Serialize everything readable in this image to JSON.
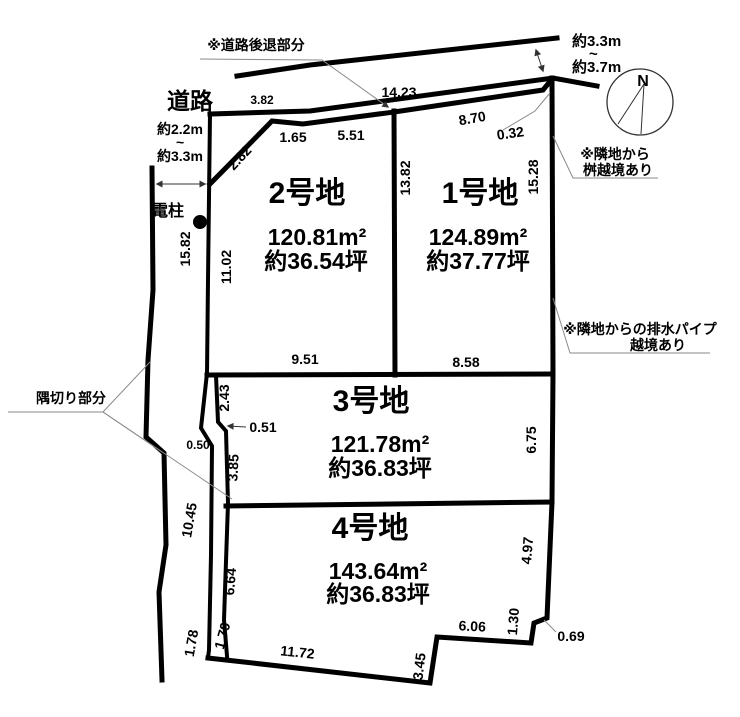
{
  "diagram": {
    "compass_label": "N",
    "road_label": "道路",
    "pole_label": "電柱",
    "setback_label": "※道路後退部分",
    "corner_cut_label": "隅切り部分",
    "masu_note": {
      "line1": "※隣地から",
      "line2": "桝越境あり"
    },
    "drain_note": {
      "line1": "※隣地からの排水パイプ",
      "line2": "越境あり"
    },
    "road_width_north": {
      "min": "約3.3m",
      "tilde": "~",
      "max": "約3.7m"
    },
    "road_width_west": {
      "min": "約2.2m",
      "tilde": "~",
      "max": "約3.3m"
    }
  },
  "plots": [
    {
      "name": "1号地",
      "area_m2": "124.89m²",
      "area_tsubo": "約37.77坪"
    },
    {
      "name": "2号地",
      "area_m2": "120.81m²",
      "area_tsubo": "約36.54坪"
    },
    {
      "name": "3号地",
      "area_m2": "121.78m²",
      "area_tsubo": "約36.83坪"
    },
    {
      "name": "4号地",
      "area_m2": "143.64m²",
      "area_tsubo": "約36.83坪"
    }
  ],
  "dimensions": {
    "front_west": "3.82",
    "front_main": "14.23",
    "plot2_corner": "2.82",
    "plot2_top_a": "1.65",
    "plot2_top_b": "5.51",
    "plot1_top": "8.70",
    "plot1_top_jog": "0.32",
    "plot1_west": "13.82",
    "plot1_east": "15.28",
    "plot1_south": "8.58",
    "plot2_west": "11.02",
    "plot2_south": "9.51",
    "west_line_upper": "15.82",
    "plot3_west_a": "2.43",
    "plot3_west_jog": "0.51",
    "road_jog": "0.50",
    "plot3_west_b": "3.85",
    "plot3_east": "6.75",
    "west_line_lower": "10.45",
    "plot4_west_a": "6.64",
    "plot4_west_b": "1.79",
    "west_line_end": "1.78",
    "plot4_south": "11.72",
    "plot4_south_b": "3.45",
    "plot4_south_c": "6.06",
    "plot4_east_jog_b": "1.30",
    "plot4_east_jog": "0.69",
    "plot4_east": "4.97"
  },
  "colors": {
    "line": "#000000",
    "background": "#ffffff",
    "leader": "#8a8a8a"
  }
}
